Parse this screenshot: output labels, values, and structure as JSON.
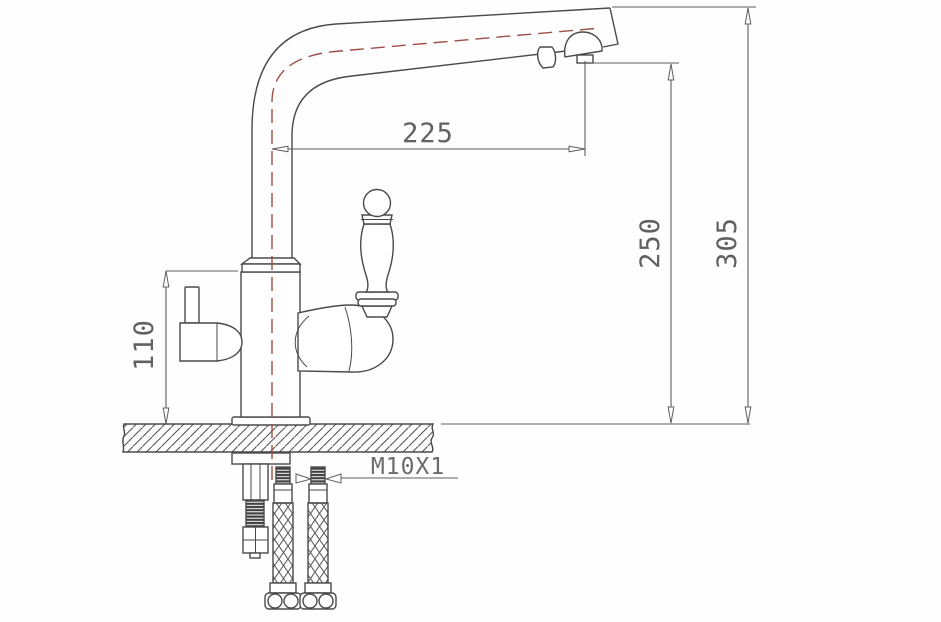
{
  "drawing": {
    "subject": "kitchen-faucet-installation-side-view",
    "dimension_labels": {
      "spout_reach": "225",
      "aerator_height": "250",
      "overall_height": "305",
      "body_height": "110",
      "mounting_thread": "M10X1"
    },
    "colors": {
      "line": "#4a4a4a",
      "dimension": "#5f5f5f",
      "centerline": "#9c4f44",
      "background": "#fefefe"
    }
  }
}
